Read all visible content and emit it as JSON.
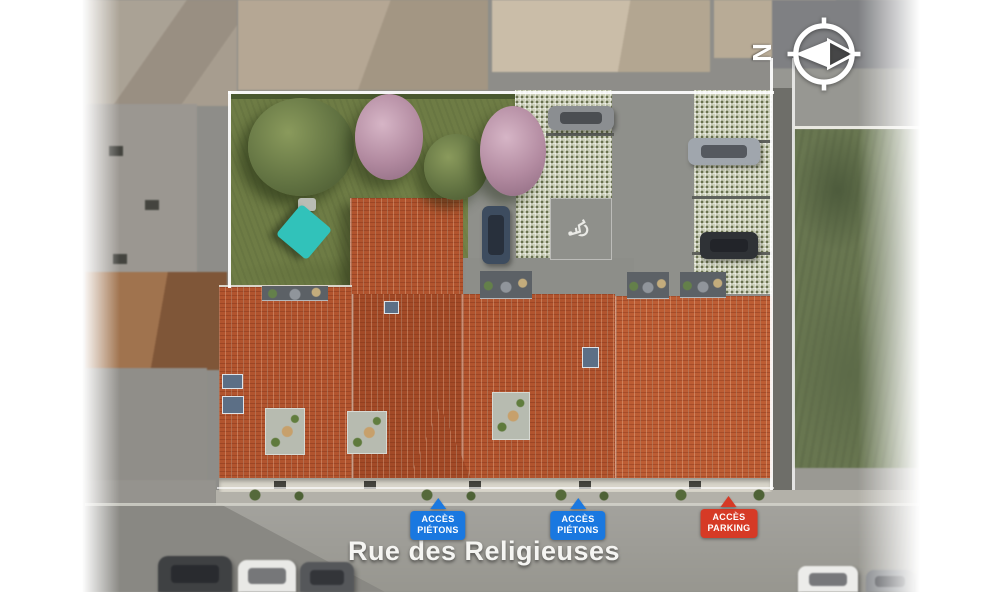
{
  "scene": {
    "street_name": "Rue des Religieuses",
    "compass_letter": "N",
    "handicap_symbol": "♿"
  },
  "markers": {
    "pedestrian_1": {
      "line1": "ACCÈS",
      "line2": "PIÉTONS"
    },
    "pedestrian_2": {
      "line1": "ACCÈS",
      "line2": "PIÉTONS"
    },
    "parking": {
      "line1": "ACCÈS",
      "line2": "PARKING"
    }
  },
  "colors": {
    "pedestrian_marker_blue": "#1a78e0",
    "parking_marker_red": "#d63a26",
    "roof_terracotta": "#b2542e",
    "lawn_green": "#6e7c45",
    "field_green": "#687650",
    "street_gray": "#9c9b96",
    "pavers_sage": "#ccd0ba",
    "shade_sail_teal": "#31c2ba"
  }
}
